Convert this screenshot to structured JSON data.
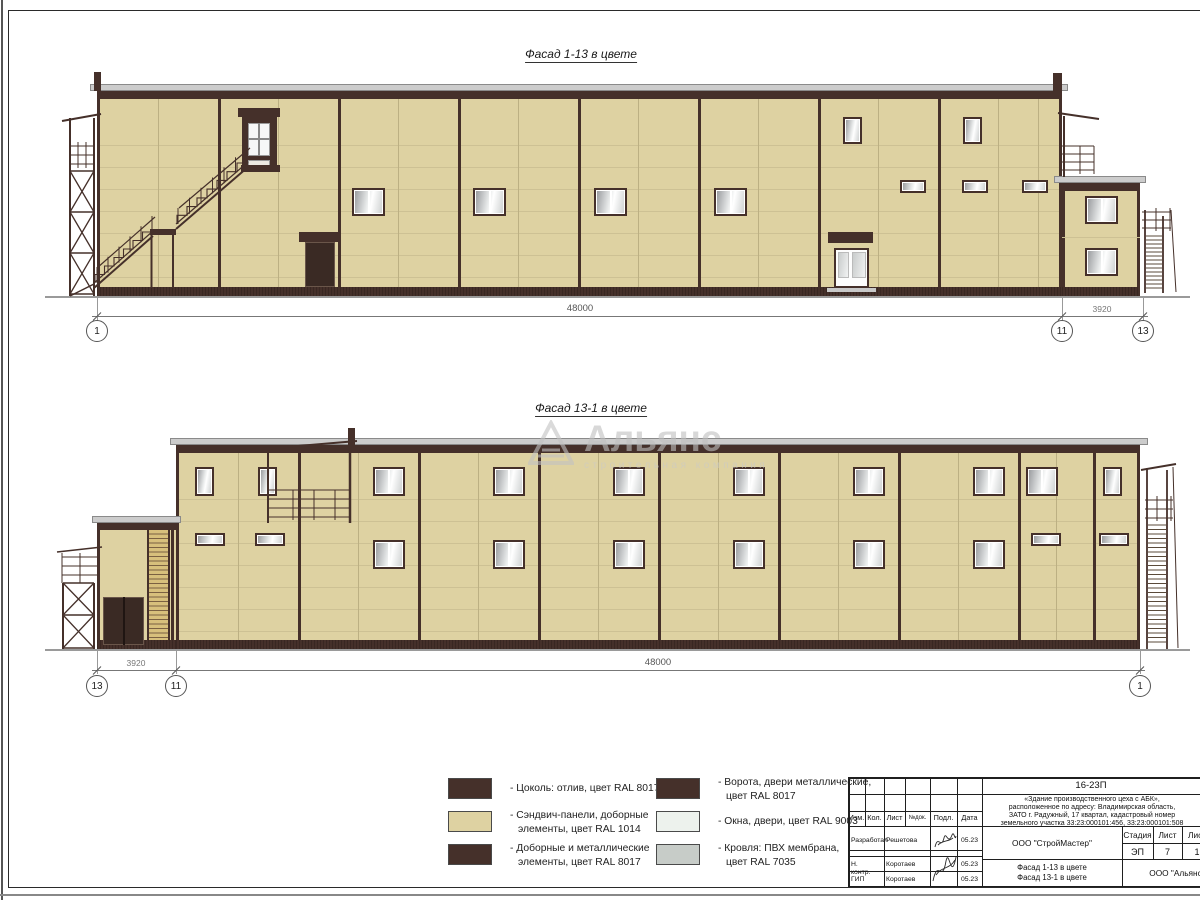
{
  "facade_top": {
    "title": "Фасад 1-13 в цвете",
    "dim_main": "48000",
    "dim_annex": "3920",
    "axis_left": "1",
    "axis_mid": "11",
    "axis_right": "13"
  },
  "facade_bottom": {
    "title": "Фасад 13-1 в цвете",
    "dim_main": "48000",
    "dim_annex": "3920",
    "axis_left": "13",
    "axis_mid": "11",
    "axis_right": "1"
  },
  "watermark": {
    "name": "Альянс",
    "subtitle": "строительная компания"
  },
  "legend": {
    "items": [
      {
        "color": "#45302A",
        "lines": [
          "- Цоколь: отлив, цвет RAL 8017"
        ]
      },
      {
        "color": "#DED2A2",
        "lines": [
          "- Сэндвич-панели, доборные",
          "элементы, цвет RAL 1014"
        ]
      },
      {
        "color": "#45302A",
        "lines": [
          "- Доборные и металлические",
          "элементы, цвет RAL 8017"
        ]
      },
      {
        "color": "#45302A",
        "lines": [
          "- Ворота, двери металлические,",
          "цвет RAL 8017"
        ]
      },
      {
        "color": "#EDF2ED",
        "lines": [
          "- Окна, двери, цвет RAL 9003"
        ]
      },
      {
        "color": "#C7CCC8",
        "lines": [
          "- Кровля: ПВХ мембрана,",
          "цвет RAL 7035"
        ]
      }
    ]
  },
  "titleblock": {
    "code": "16-23П",
    "desc_lines": [
      "«Здание производственного цеха с АБК»,",
      "расположенное по адресу: Владимирская область,",
      "ЗАТО г. Радужный, 17 квартал, кадастровый номер",
      "земельного участка 33:23:000101:456, 33:23:000101:508"
    ],
    "cols": [
      "Изм.",
      "Кол.",
      "Лист",
      "№док.",
      "Подл.",
      "Дата"
    ],
    "rows": [
      {
        "role": "Разработал",
        "name": "Решетова",
        "date": "05.23"
      },
      {
        "role": "Н. контр.",
        "name": "Коротаев",
        "date": "05.23"
      },
      {
        "role": "ГИП",
        "name": "Коротаев",
        "date": "05.23"
      }
    ],
    "org": "ООО \"СтройМастер\"",
    "sheet_title_1": "Фасад 1-13 в цвете",
    "sheet_title_2": "Фасад 13-1 в цвете",
    "stage_label": "Стадия",
    "sheet_label": "Лист",
    "sheets_label": "Лис",
    "stage": "ЭП",
    "sheet_no": "7",
    "sheets_total": "1",
    "org2": "ООО \"Альянс\""
  },
  "colors": {
    "panel_ral1014": "#DED2A2",
    "trim_ral8017": "#45302A",
    "windows_ral9003": "#EDF2ED",
    "roof_ral7035": "#C7CCC8"
  }
}
